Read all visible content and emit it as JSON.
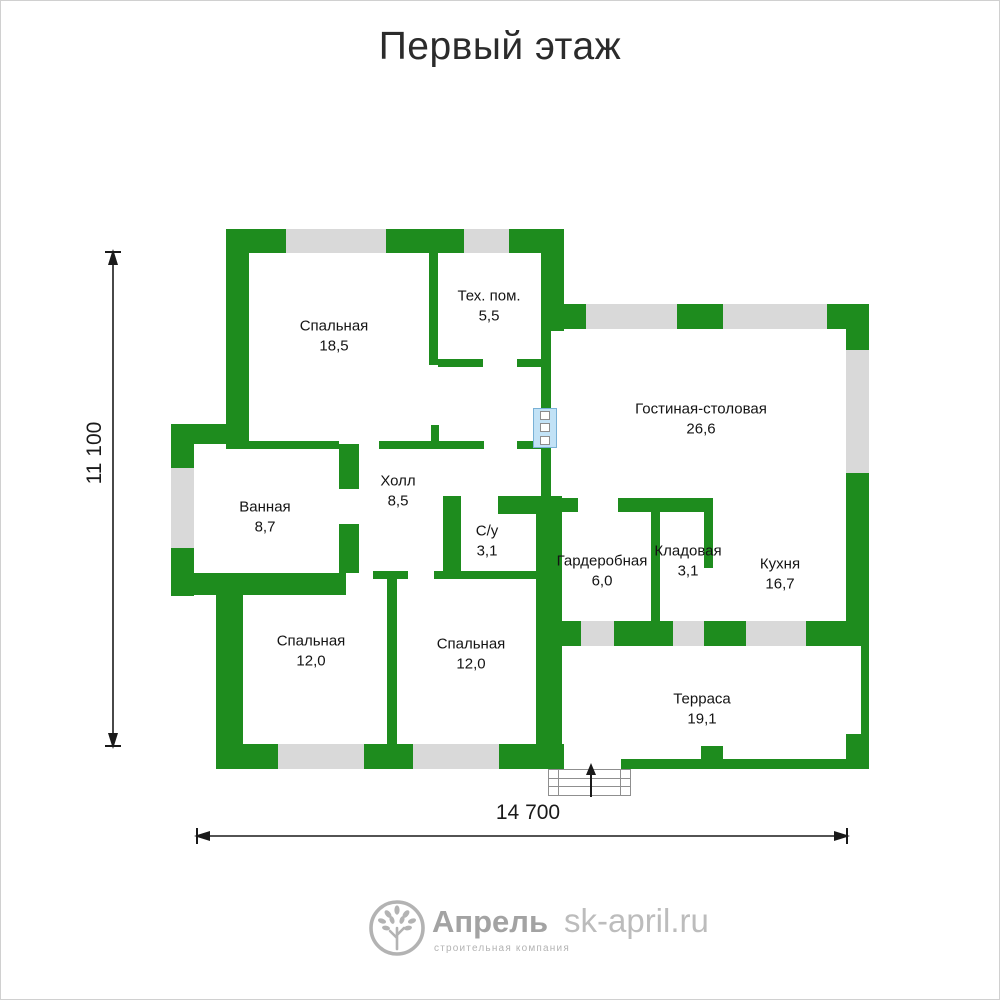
{
  "title": "Первый этаж",
  "plan": {
    "rooms": [
      {
        "name": "Спальная",
        "area": "18,5"
      },
      {
        "name": "Тех. пом.",
        "area": "5,5"
      },
      {
        "name": "Гостиная-столовая",
        "area": "26,6"
      },
      {
        "name": "Ванная",
        "area": "8,7"
      },
      {
        "name": "Холл",
        "area": "8,5"
      },
      {
        "name": "С/у",
        "area": "3,1"
      },
      {
        "name": "Гардеробная",
        "area": "6,0"
      },
      {
        "name": "Кладовая",
        "area": "3,1"
      },
      {
        "name": "Кухня",
        "area": "16,7"
      },
      {
        "name": "Спальная",
        "area": "12,0"
      },
      {
        "name": "Спальная",
        "area": "12,0"
      },
      {
        "name": "Терраса",
        "area": "19,1"
      }
    ],
    "dimensions": {
      "height": "11 100",
      "width": "14 700"
    },
    "colors": {
      "wall": "#1e8c1e",
      "window": "#d9d9d9",
      "blue_window": "#c2e2f6"
    }
  },
  "footer": {
    "logo_text": "Апрель",
    "logo_subtext": "строительная компания",
    "website": "sk-april.ru"
  }
}
